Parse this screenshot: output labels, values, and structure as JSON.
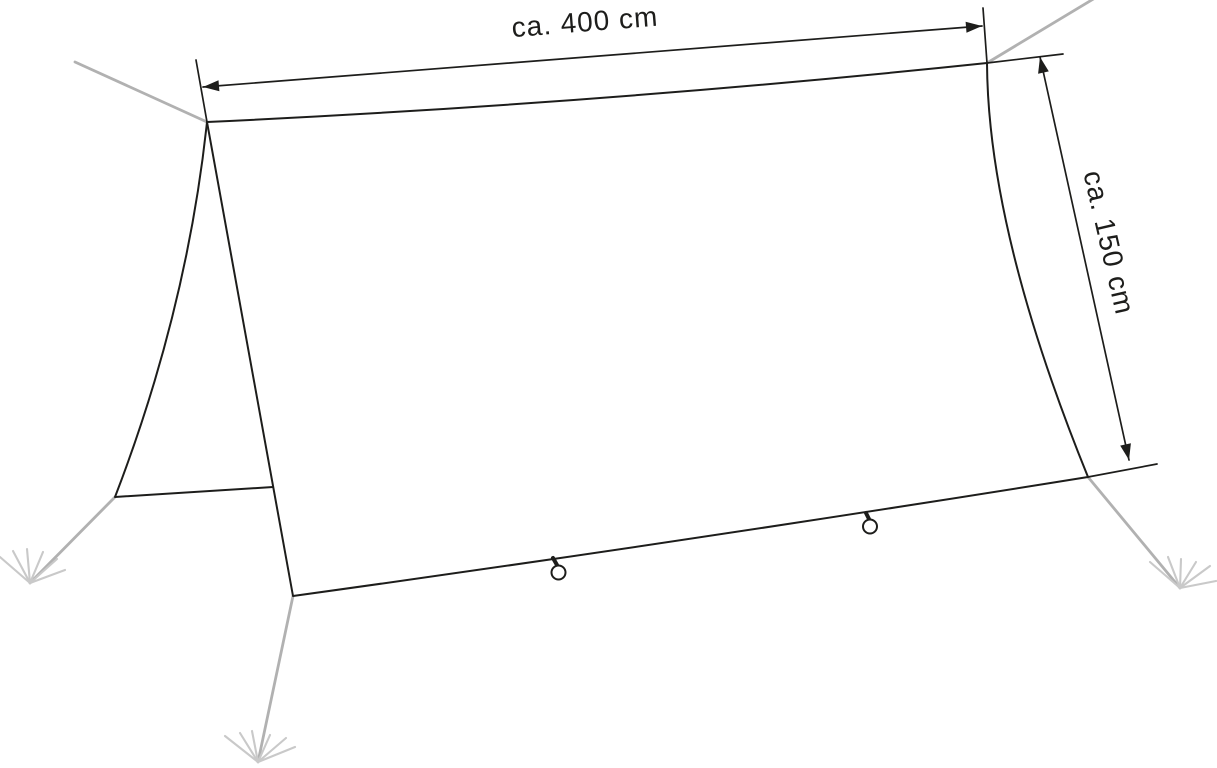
{
  "diagram": {
    "labels": {
      "width": "ca. 400 cm",
      "depth": "ca. 150 cm"
    },
    "colors": {
      "outline": "#1d1d1b",
      "dimension": "#1d1d1b",
      "guy_line": "#b1b1b1",
      "stake_marks": "#c9c9c9",
      "background": "#ffffff"
    }
  }
}
